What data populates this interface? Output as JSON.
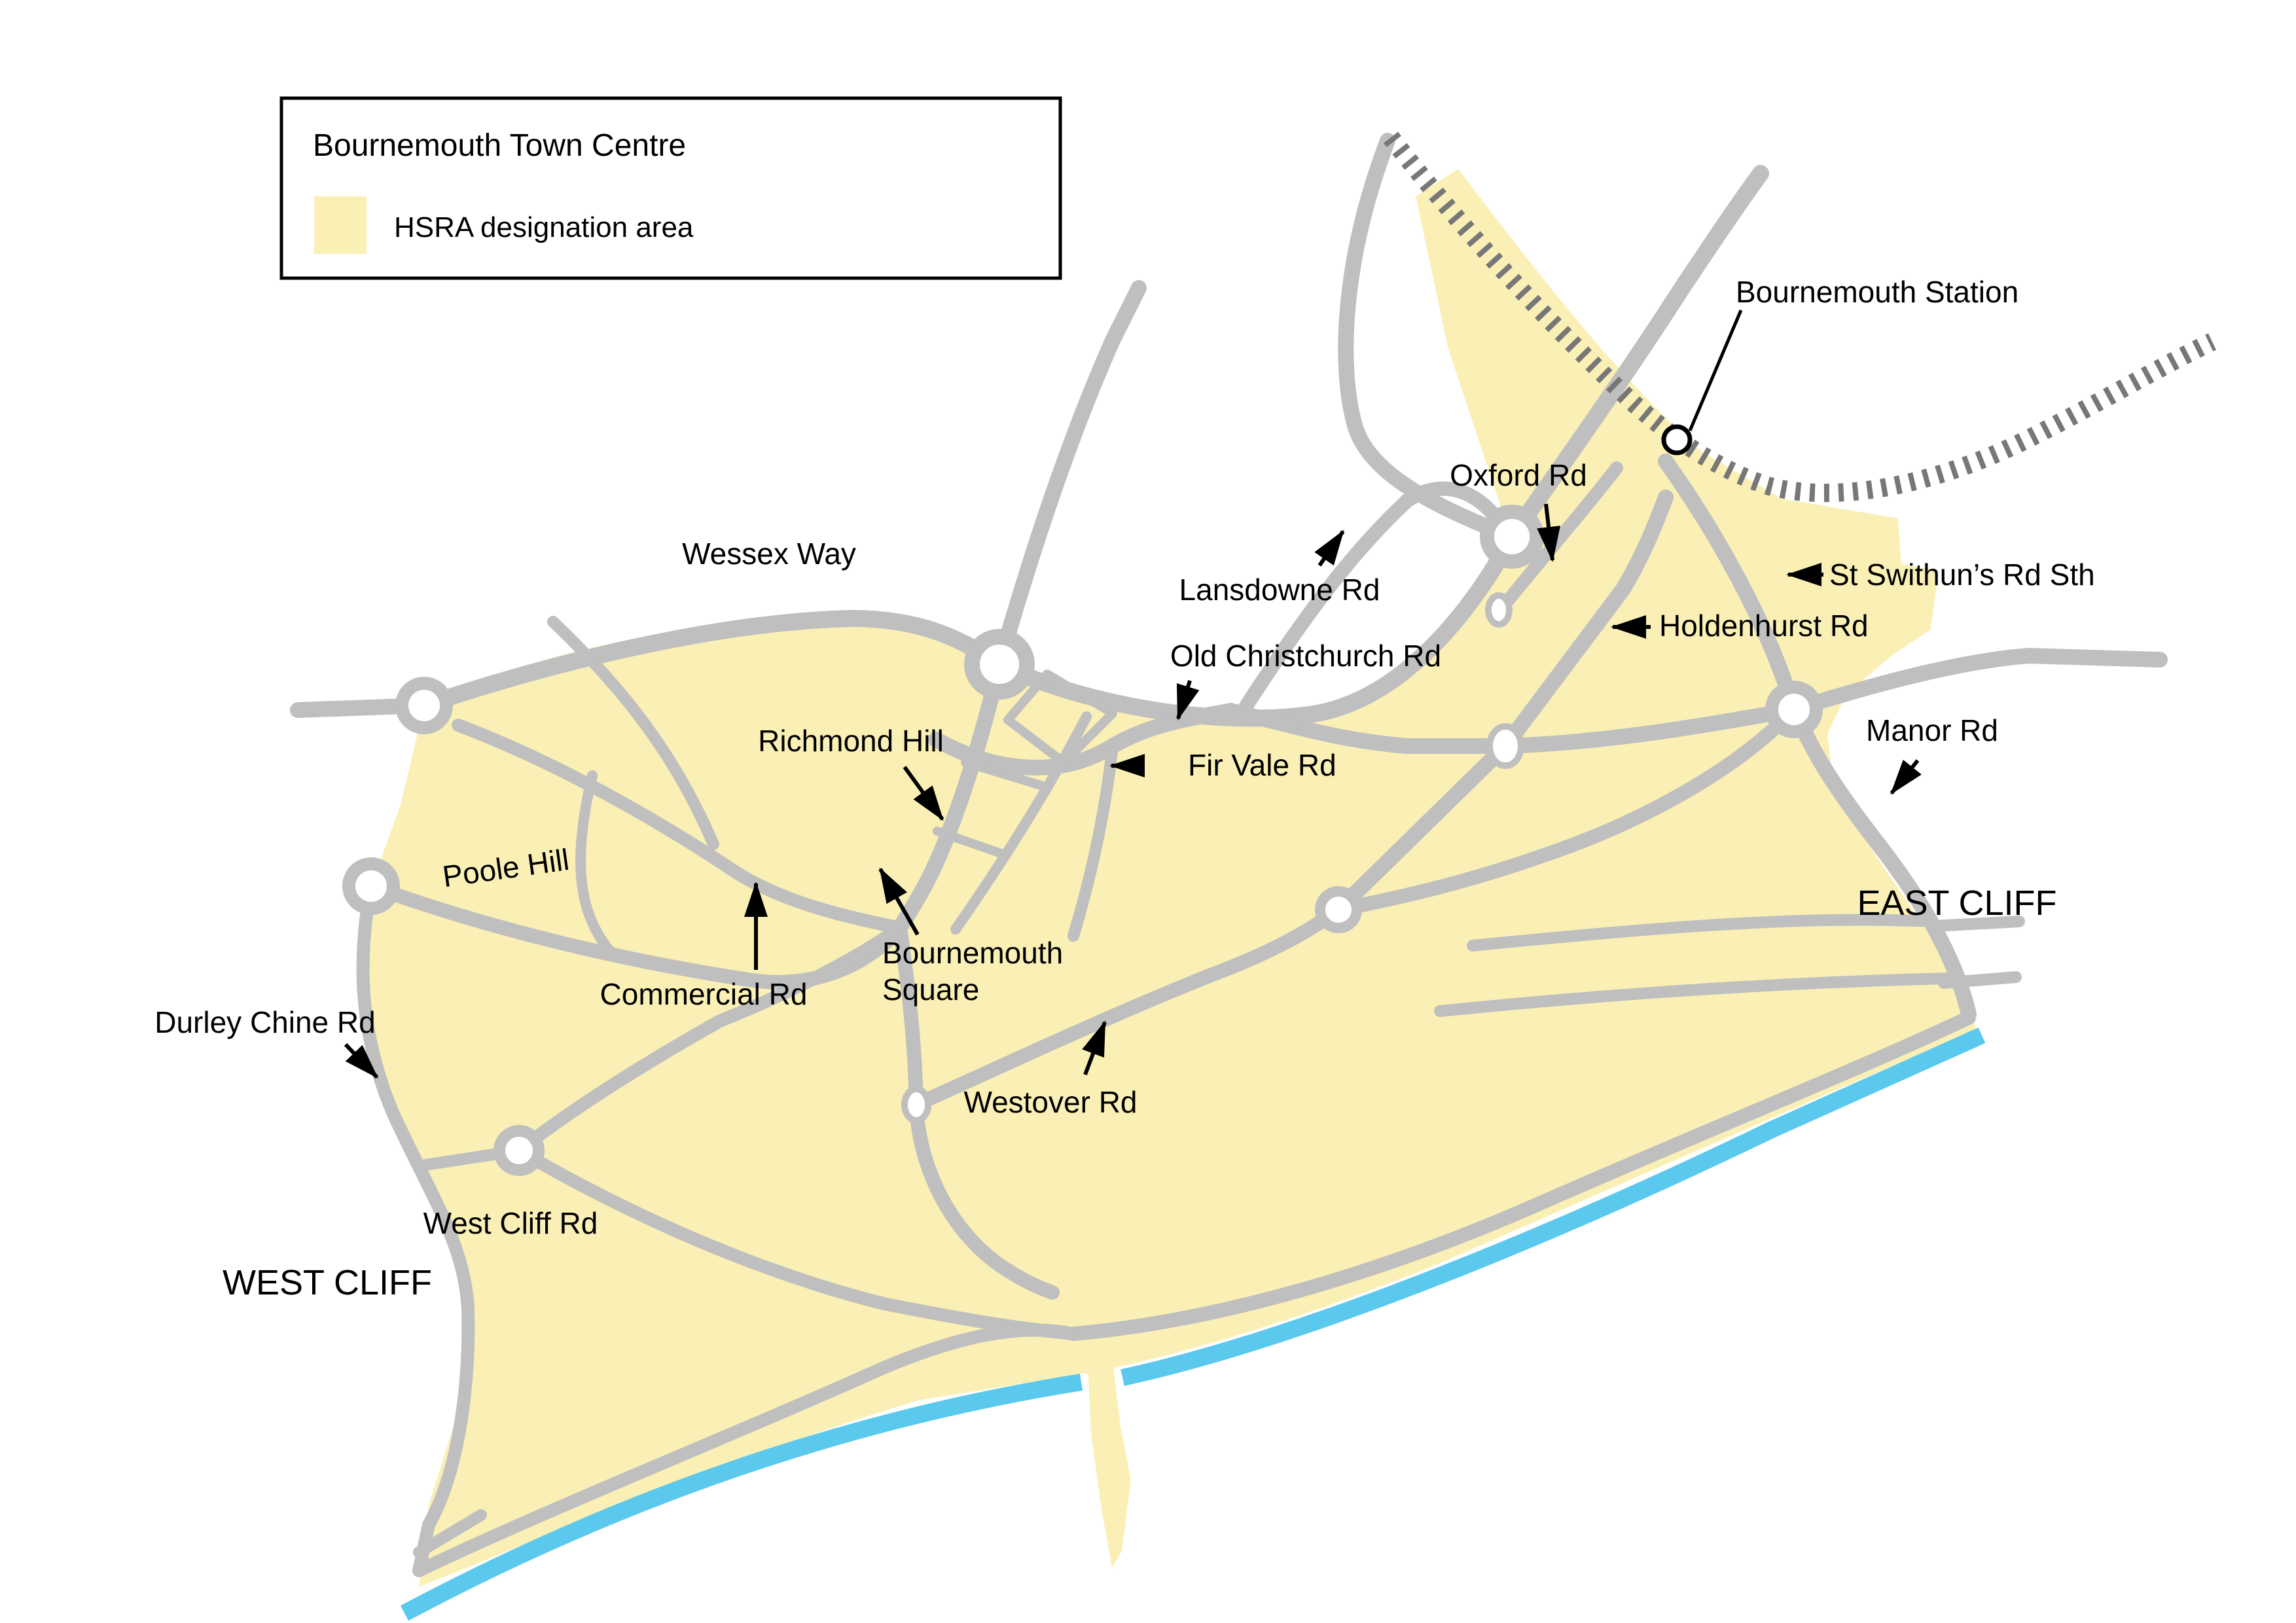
{
  "legend": {
    "title": "Bournemouth Town Centre",
    "hsra_label": "HSRA designation area"
  },
  "labels": {
    "wessex_way": "Wessex Way",
    "richmond_hill": "Richmond Hill",
    "poole_hill": "Poole Hill",
    "commercial_rd": "Commercial Rd",
    "bournemouth_square_line1": "Bournemouth",
    "bournemouth_square_line2": "Square",
    "westover_rd": "Westover Rd",
    "durley_chine_rd": "Durley Chine Rd",
    "west_cliff_rd": "West Cliff Rd",
    "west_cliff": "WEST CLIFF",
    "east_cliff": "EAST CLIFF",
    "manor_rd": "Manor Rd",
    "old_christchurch_rd": "Old Christchurch Rd",
    "lansdowne_rd": "Lansdowne Rd",
    "oxford_rd": "Oxford Rd",
    "holdenhurst_rd": "Holdenhurst Rd",
    "st_swithuns_rd_sth": "St Swithun’s Rd Sth",
    "fir_vale_rd": "Fir Vale Rd",
    "bournemouth_station": "Bournemouth Station"
  },
  "colors": {
    "hsra_yellow": "#FAF0B6",
    "road_gray": "#BFBFBF",
    "rail_gray": "#777777",
    "sea_blue": "#5BC9EE",
    "text_black": "#000000",
    "background": "#FFFFFF"
  }
}
